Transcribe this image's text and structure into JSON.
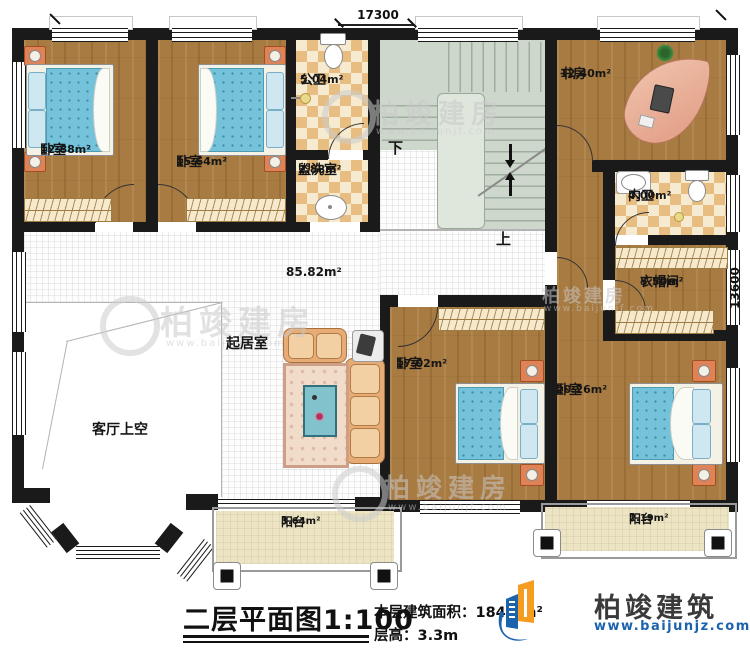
{
  "dimensions": {
    "top": "17300",
    "right": "13600"
  },
  "rooms": [
    {
      "id": "bedroom-1",
      "name": "卧室",
      "area": "12.88m²"
    },
    {
      "id": "bedroom-2",
      "name": "卧室",
      "area": "15.64m²"
    },
    {
      "id": "public-bath",
      "name": "公卫",
      "area": "5.04m²"
    },
    {
      "id": "washroom",
      "name": "盥洗室",
      "area": "2.88m²"
    },
    {
      "id": "study",
      "name": "书房",
      "area": "12.40m²"
    },
    {
      "id": "ensuite-bath",
      "name": "内卫",
      "area": "4.00m²"
    },
    {
      "id": "cloakroom",
      "name": "衣帽间",
      "area": "5.50m²"
    },
    {
      "id": "bedroom-3",
      "name": "卧室",
      "area": "17.02m²"
    },
    {
      "id": "bedroom-4",
      "name": "卧室",
      "area": "20.26m²"
    },
    {
      "id": "living-hall",
      "name": "起居室",
      "area": "85.82m²"
    },
    {
      "id": "void",
      "name": "客厅上空"
    },
    {
      "id": "balcony-left",
      "name": "阳台",
      "area": "3.64m²"
    },
    {
      "id": "balcony-right",
      "name": "阳台",
      "area": "2.19m²"
    }
  ],
  "stairs": {
    "down": "下",
    "up": "上"
  },
  "titleblock": {
    "title": "二层平面图",
    "scale": "1:100",
    "floor_area_label": "本层建筑面积：",
    "floor_area": "184.8m²",
    "height_label": "层高：",
    "height": "3.3m"
  },
  "brand": {
    "name": "柏竣建筑",
    "website": "www.baijunjz.com"
  },
  "watermark": {
    "text": "柏竣建房",
    "url": "www.baijunjf.com"
  },
  "colors": {
    "wall": "#1a1a1a",
    "brand_blue": "#1b63ad",
    "brand_orange": "#f59d20"
  }
}
